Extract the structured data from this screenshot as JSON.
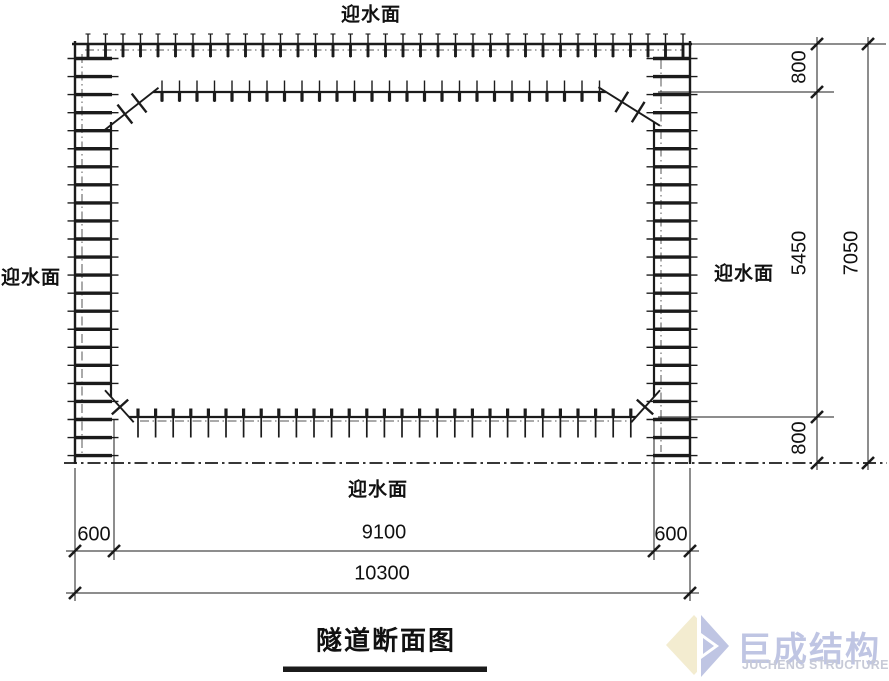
{
  "drawing": {
    "title": "隧道断面图",
    "labels": {
      "top": "迎水面",
      "left": "迎水面",
      "right": "迎水面",
      "bottom": "迎水面"
    },
    "dimensions": {
      "right_top": "800",
      "right_middle": "5450",
      "right_bottom": "800",
      "right_total": "7050",
      "bottom_left": "600",
      "bottom_center": "9100",
      "bottom_right": "600",
      "bottom_total": "10300"
    }
  },
  "logo": {
    "name_cn": "巨成结构",
    "name_en": "JUCHENG STRUCTURE",
    "colors": {
      "blue": "#bfc5e3",
      "yellow": "#f3ecd0",
      "en_gray": "#c7cad7"
    }
  },
  "colors": {
    "line": "#1b1b1b",
    "background": "#ffffff"
  }
}
